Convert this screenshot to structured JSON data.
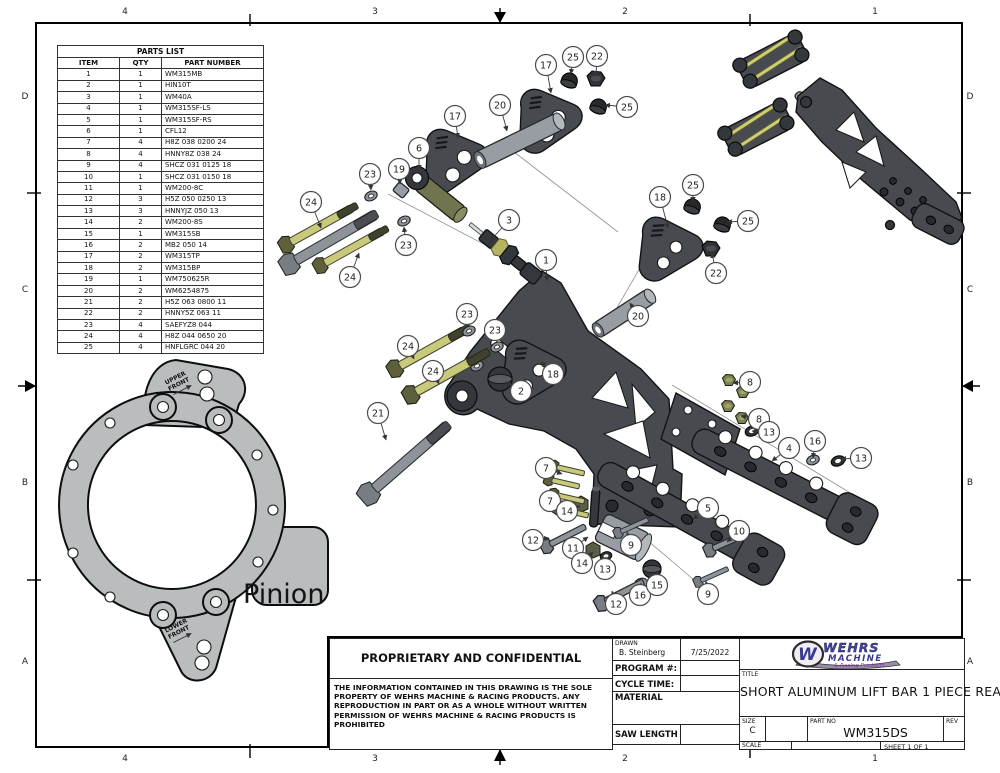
{
  "border": {
    "columns": [
      {
        "label": "4",
        "x": 125
      },
      {
        "label": "3",
        "x": 375
      },
      {
        "label": "2",
        "x": 625
      },
      {
        "label": "1",
        "x": 875
      }
    ],
    "rows": [
      {
        "label": "D",
        "y": 97
      },
      {
        "label": "C",
        "y": 290
      },
      {
        "label": "B",
        "y": 483
      },
      {
        "label": "A",
        "y": 662
      }
    ]
  },
  "parts_list": {
    "title": "PARTS LIST",
    "headers": [
      "ITEM",
      "QTY",
      "PART NUMBER"
    ],
    "rows": [
      [
        "1",
        "1",
        "WM315MB"
      ],
      [
        "2",
        "1",
        "HIN10T"
      ],
      [
        "3",
        "1",
        "WM40A"
      ],
      [
        "4",
        "1",
        "WM315SF-LS"
      ],
      [
        "5",
        "1",
        "WM315SF-RS"
      ],
      [
        "6",
        "1",
        "CFL12"
      ],
      [
        "7",
        "4",
        "H8Z 038 0200 24"
      ],
      [
        "8",
        "4",
        "HNNY8Z 038 24"
      ],
      [
        "9",
        "4",
        "SHCZ 031 0125 18"
      ],
      [
        "10",
        "1",
        "SHCZ 031 0150 18"
      ],
      [
        "11",
        "1",
        "WM200-8C"
      ],
      [
        "12",
        "3",
        "H5Z 050 0250 13"
      ],
      [
        "13",
        "3",
        "HNNYJZ 050 13"
      ],
      [
        "14",
        "2",
        "WM200-8S"
      ],
      [
        "15",
        "1",
        "WM315SB"
      ],
      [
        "16",
        "2",
        "MB2 050 14"
      ],
      [
        "17",
        "2",
        "WM315TP"
      ],
      [
        "18",
        "2",
        "WM315BP"
      ],
      [
        "19",
        "1",
        "WM750625R"
      ],
      [
        "20",
        "2",
        "WM6254875"
      ],
      [
        "21",
        "2",
        "H5Z 063 0800 11"
      ],
      [
        "22",
        "2",
        "HNNY5Z 063 11"
      ],
      [
        "23",
        "4",
        "SAEFYZ8 044"
      ],
      [
        "24",
        "4",
        "H8Z 044 0650 20"
      ],
      [
        "25",
        "4",
        "HNFLGRC 044 20"
      ]
    ]
  },
  "pinion": {
    "name": "Pinion",
    "upper_line1": "UPPER",
    "upper_line2": "FRONT",
    "lower_line1": "LOWER",
    "lower_line2": "FRONT"
  },
  "proprietary": {
    "heading": "PROPRIETARY AND CONFIDENTIAL",
    "body": "THE INFORMATION CONTAINED IN THIS DRAWING IS THE SOLE PROPERTY OF WEHRS MACHINE & RACING PRODUCTS. ANY REPRODUCTION IN PART OR AS A WHOLE WITHOUT WRITTEN PERMISSION OF WEHRS MACHINE & RACING PRODUCTS IS PROHIBITED"
  },
  "title_block": {
    "drawn_label": "DRAWN",
    "drawn_name": "B. Steinberg",
    "drawn_date": "7/25/2022",
    "program_label": "PROGRAM #:",
    "cycle_label": "CYCLE TIME:",
    "material_label": "MATERIAL",
    "saw_label": "SAW LENGTH",
    "title_label": "TITLE",
    "title": "SHORT ALUMINUM LIFT BAR 1 PIECE REAR",
    "size_label": "SIZE",
    "size": "C",
    "part_no_label": "PART NO",
    "part_no": "WM315DS",
    "rev_label": "REV",
    "scale_label": "SCALE",
    "sheet": "SHEET 1  OF 1"
  },
  "logo": {
    "monogram": "W",
    "word1": "WEHRS",
    "word2": "MACHINE",
    "tagline": "& Racing Products",
    "navy": "#3a3a8e",
    "purple": "#7a3f9d"
  },
  "colors": {
    "part_dark": "#474b50",
    "bolt_olive": "#c9c97b",
    "tube_gray": "#979da2",
    "plate_gray": "#b9bdbd"
  },
  "balloons": [
    {
      "n": "17",
      "x": 546,
      "y": 65,
      "ax": 551,
      "ay": 93
    },
    {
      "n": "25",
      "x": 573,
      "y": 57,
      "ax": 571,
      "ay": 74
    },
    {
      "n": "22",
      "x": 597,
      "y": 56,
      "ax": 596,
      "ay": 76
    },
    {
      "n": "20",
      "x": 500,
      "y": 105,
      "ax": 507,
      "ay": 131
    },
    {
      "n": "25",
      "x": 627,
      "y": 107,
      "ax": 605,
      "ay": 105
    },
    {
      "n": "17",
      "x": 455,
      "y": 116,
      "ax": 458,
      "ay": 138
    },
    {
      "n": "6",
      "x": 419,
      "y": 148,
      "ax": 419,
      "ay": 170
    },
    {
      "n": "19",
      "x": 399,
      "y": 169,
      "ax": 400,
      "ay": 184
    },
    {
      "n": "23",
      "x": 370,
      "y": 174,
      "ax": 371,
      "ay": 190
    },
    {
      "n": "24",
      "x": 311,
      "y": 202,
      "ax": 321,
      "ay": 228
    },
    {
      "n": "3",
      "x": 509,
      "y": 220,
      "ax": 490,
      "ay": 241
    },
    {
      "n": "23",
      "x": 406,
      "y": 245,
      "ax": 404,
      "ay": 227
    },
    {
      "n": "1",
      "x": 546,
      "y": 260,
      "ax": 547,
      "ay": 281
    },
    {
      "n": "24",
      "x": 350,
      "y": 277,
      "ax": 359,
      "ay": 253
    },
    {
      "n": "18",
      "x": 660,
      "y": 197,
      "ax": 668,
      "ay": 228
    },
    {
      "n": "25",
      "x": 693,
      "y": 185,
      "ax": 693,
      "ay": 202
    },
    {
      "n": "25",
      "x": 748,
      "y": 221,
      "ax": 727,
      "ay": 222
    },
    {
      "n": "22",
      "x": 716,
      "y": 273,
      "ax": 712,
      "ay": 253
    },
    {
      "n": "20",
      "x": 638,
      "y": 316,
      "ax": 630,
      "ay": 303
    },
    {
      "n": "23",
      "x": 467,
      "y": 314,
      "ax": 469,
      "ay": 327
    },
    {
      "n": "23",
      "x": 495,
      "y": 330,
      "ax": 497,
      "ay": 342
    },
    {
      "n": "24",
      "x": 408,
      "y": 346,
      "ax": 414,
      "ay": 359
    },
    {
      "n": "24",
      "x": 433,
      "y": 371,
      "ax": 439,
      "ay": 384
    },
    {
      "n": "21",
      "x": 378,
      "y": 413,
      "ax": 386,
      "ay": 440
    },
    {
      "n": "2",
      "x": 521,
      "y": 391,
      "ax": 506,
      "ay": 382
    },
    {
      "n": "18",
      "x": 553,
      "y": 374,
      "ax": 541,
      "ay": 362
    },
    {
      "n": "8",
      "x": 750,
      "y": 382,
      "ax": 733,
      "ay": 383
    },
    {
      "n": "8",
      "x": 759,
      "y": 419,
      "ax": 741,
      "ay": 416
    },
    {
      "n": "13",
      "x": 769,
      "y": 432,
      "ax": 752,
      "ay": 431
    },
    {
      "n": "4",
      "x": 789,
      "y": 448,
      "ax": 772,
      "ay": 461
    },
    {
      "n": "16",
      "x": 815,
      "y": 441,
      "ax": 813,
      "ay": 458
    },
    {
      "n": "13",
      "x": 861,
      "y": 458,
      "ax": 841,
      "ay": 459
    },
    {
      "n": "7",
      "x": 546,
      "y": 468,
      "ax": 562,
      "ay": 474
    },
    {
      "n": "7",
      "x": 550,
      "y": 501,
      "ax": 566,
      "ay": 503
    },
    {
      "n": "14",
      "x": 567,
      "y": 511,
      "ax": 580,
      "ay": 506
    },
    {
      "n": "12",
      "x": 533,
      "y": 540,
      "ax": 549,
      "ay": 538
    },
    {
      "n": "11",
      "x": 573,
      "y": 548,
      "ax": 588,
      "ay": 537
    },
    {
      "n": "14",
      "x": 582,
      "y": 563,
      "ax": 593,
      "ay": 552
    },
    {
      "n": "13",
      "x": 605,
      "y": 569,
      "ax": 606,
      "ay": 557
    },
    {
      "n": "9",
      "x": 631,
      "y": 545,
      "ax": 627,
      "ay": 532
    },
    {
      "n": "16",
      "x": 640,
      "y": 595,
      "ax": 641,
      "ay": 583
    },
    {
      "n": "15",
      "x": 657,
      "y": 585,
      "ax": 652,
      "ay": 573
    },
    {
      "n": "12",
      "x": 616,
      "y": 604,
      "ax": 612,
      "ay": 591
    },
    {
      "n": "9",
      "x": 708,
      "y": 594,
      "ax": 706,
      "ay": 581
    },
    {
      "n": "5",
      "x": 708,
      "y": 508,
      "ax": 693,
      "ay": 519
    },
    {
      "n": "10",
      "x": 739,
      "y": 531,
      "ax": 727,
      "ay": 542
    }
  ]
}
